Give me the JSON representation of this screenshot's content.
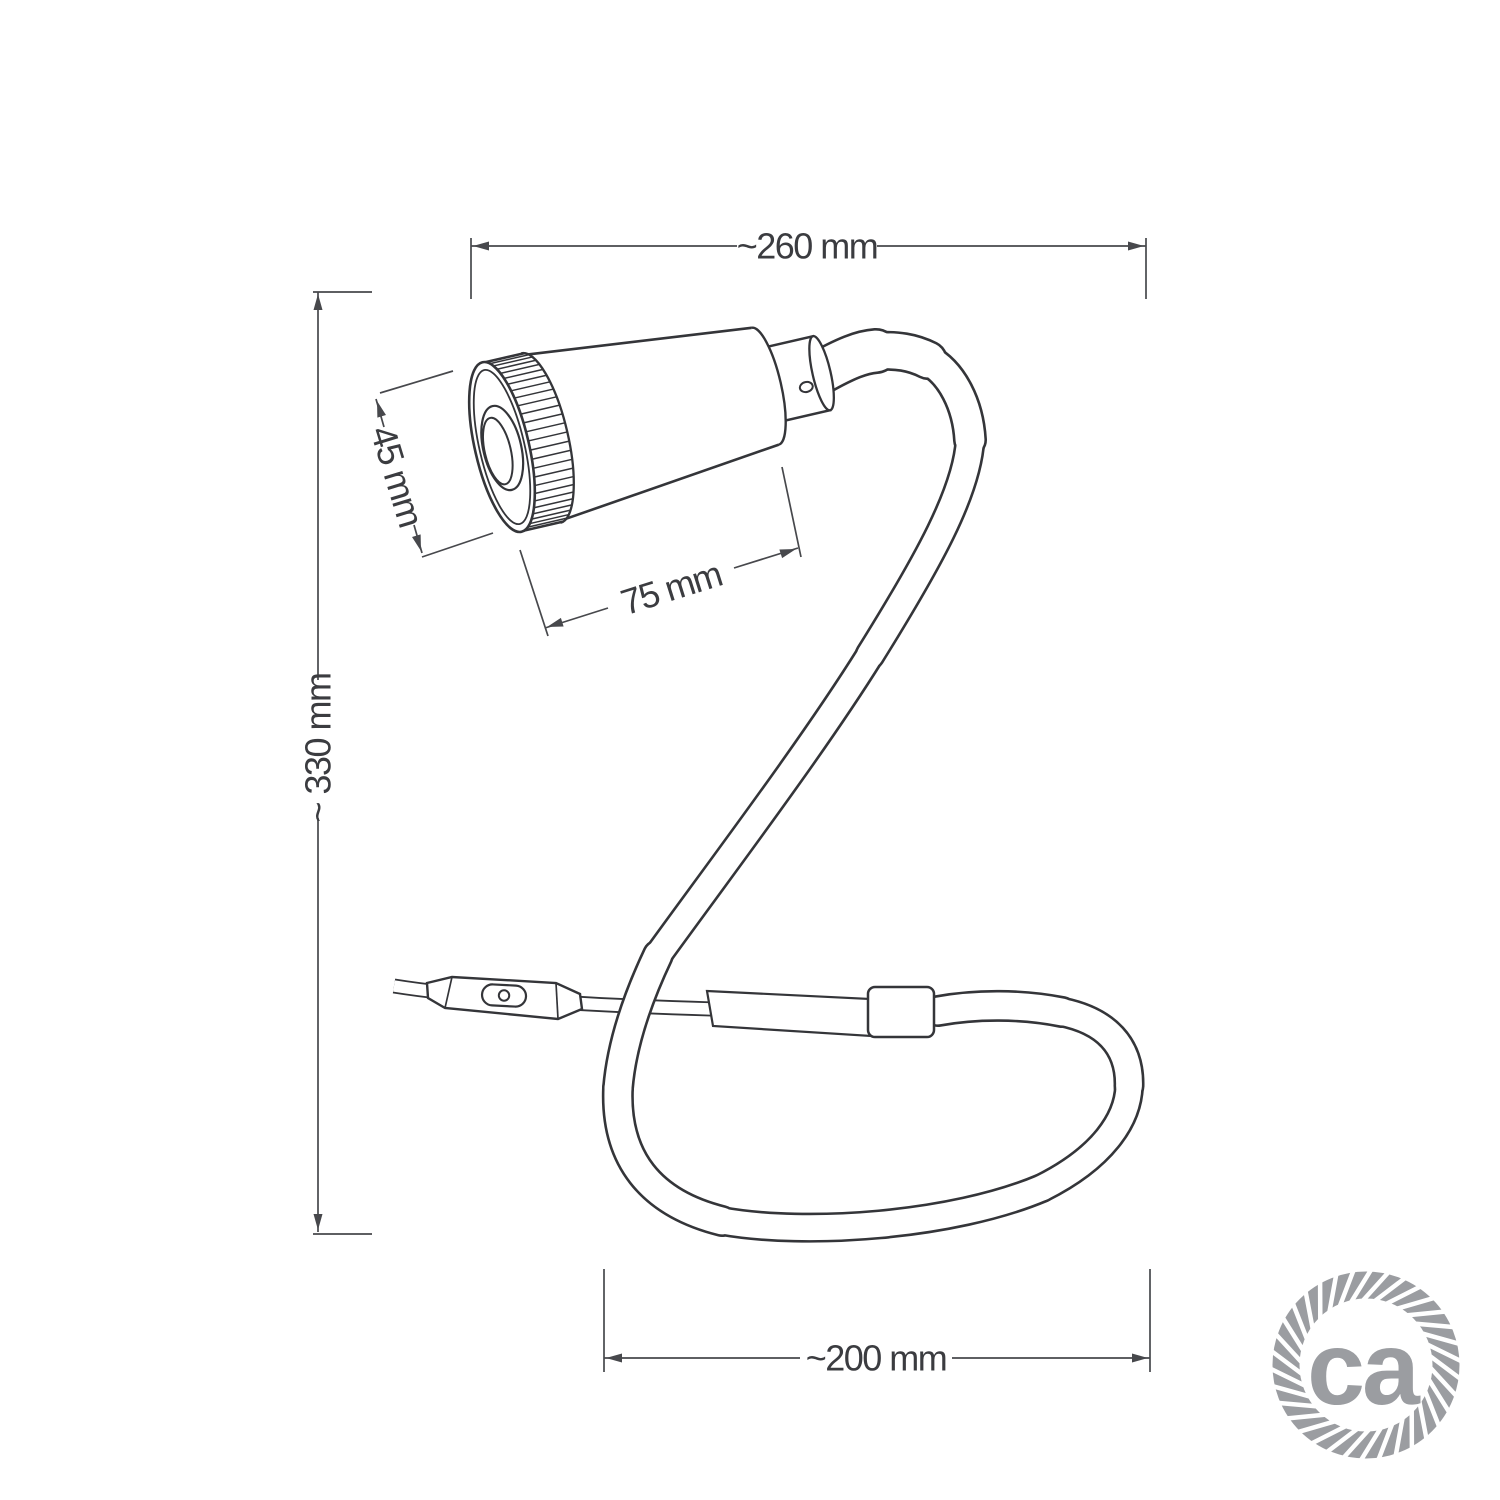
{
  "diagram": {
    "type": "product dimension drawing",
    "subject": "gooseneck spotlight table lamp",
    "colors": {
      "line": "#343539",
      "dimension": "#47484c",
      "text": "#3b3c40",
      "background": "#ffffff",
      "logo": "#9b9da1"
    },
    "dimensions": {
      "overall_width": {
        "label": "~260 mm"
      },
      "overall_height": {
        "label": "~ 330 mm"
      },
      "head_diameter": {
        "label": "45 mm"
      },
      "head_length": {
        "label": "75 mm"
      },
      "base_loop_width": {
        "label": "~200 mm"
      }
    },
    "logo": {
      "text": "ca"
    }
  }
}
